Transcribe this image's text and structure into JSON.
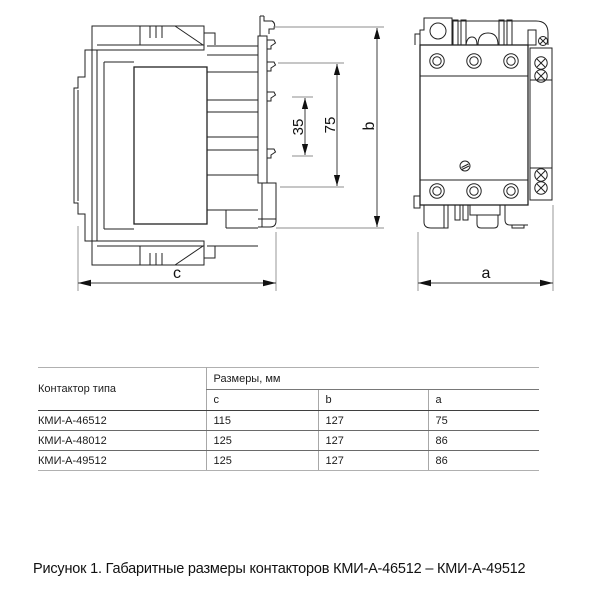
{
  "figure": {
    "dimension_labels": {
      "d35": "35",
      "d75": "75",
      "b": "b",
      "c": "c",
      "a": "a"
    }
  },
  "table": {
    "type_header": "Контактор типа",
    "dims_header": "Размеры, мм",
    "subheaders": [
      "c",
      "b",
      "a"
    ],
    "rows": [
      {
        "type": "КМИ-А-46512",
        "c": "115",
        "b": "127",
        "a": "75"
      },
      {
        "type": "КМИ-А-48012",
        "c": "125",
        "b": "127",
        "a": "86"
      },
      {
        "type": "КМИ-А-49512",
        "c": "125",
        "b": "127",
        "a": "86"
      }
    ]
  },
  "caption": "Рисунок 1. Габаритные размеры контакторов КМИ-А-46512 – КМИ-А-49512"
}
